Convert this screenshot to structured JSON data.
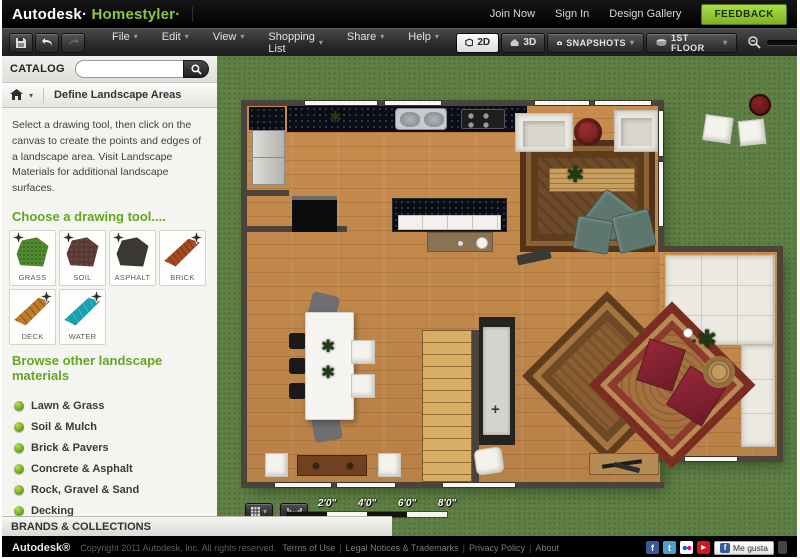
{
  "header": {
    "brand": {
      "autodesk": "Autodesk·",
      "homestyler": "Homestyler·"
    },
    "links": [
      "Join Now",
      "Sign In",
      "Design Gallery"
    ],
    "feedback_label": "FEEDBACK"
  },
  "toolbar": {
    "menus": [
      "File",
      "Edit",
      "View",
      "Shopping List",
      "Share",
      "Help"
    ],
    "view_2d": "2D",
    "view_3d": "3D",
    "snapshots_label": "SNAPSHOTS",
    "floor_label": "1ST FLOOR"
  },
  "sidebar": {
    "catalog_label": "CATALOG",
    "search_value": "",
    "panel_title": "Define Landscape Areas",
    "description": "Select a drawing tool, then click on the canvas to create the points and edges of a landscape area. Visit Landscape Materials for additional landscape surfaces.",
    "tools_heading": "Choose a drawing tool....",
    "tools": [
      {
        "label": "GRASS",
        "color": "#4f8a2e"
      },
      {
        "label": "SOIL",
        "color": "#5b3a35"
      },
      {
        "label": "ASPHALT",
        "color": "#3b3733"
      },
      {
        "label": "BRICK",
        "color": "#a14c24"
      },
      {
        "label": "DECK",
        "color": "#bf7c2d"
      },
      {
        "label": "WATER",
        "color": "#16a0b0"
      }
    ],
    "browse_heading": "Browse other landscape materials",
    "materials": [
      "Lawn & Grass",
      "Soil & Mulch",
      "Brick & Pavers",
      "Concrete & Asphalt",
      "Rock, Gravel & Sand",
      "Decking",
      "Water"
    ],
    "brands_label": "BRANDS & COLLECTIONS"
  },
  "canvas": {
    "scale_labels": [
      "2'0\"",
      "4'0\"",
      "6'0\"",
      "8'0\""
    ]
  },
  "footer": {
    "brand": "Autodesk®",
    "copyright": "Copyright 2011 Autodesk, Inc. All rights reserved.",
    "links": [
      "Terms of Use",
      "Legal Notices & Trademarks",
      "Privacy Policy",
      "About"
    ],
    "separator": "|",
    "like_label": "Me gusta"
  },
  "icons": {
    "caret": "▾",
    "facebook": "f",
    "twitter": "t",
    "youtube": "▶",
    "plant": "✱",
    "cross": "+"
  },
  "colors": {
    "brand_green": "#8dc63f",
    "heading_green": "#63a61f",
    "grass": "#5f8044",
    "wood_floor": "#c18a4f",
    "wall": "#4c443a",
    "feedback_button": "#7fb225"
  }
}
